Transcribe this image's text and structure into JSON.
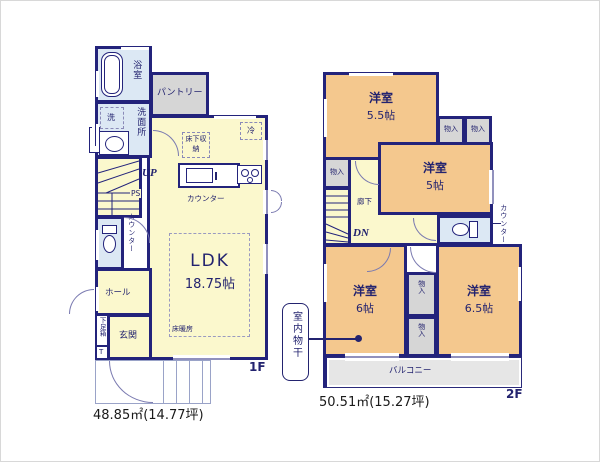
{
  "meta": {
    "floor1_label": "1F",
    "floor2_label": "2F",
    "floor1_area": "48.85㎡(14.77坪)",
    "floor2_area": "50.51㎡(15.27坪)"
  },
  "f1": {
    "bath": "浴室",
    "laundry": "洗",
    "washroom": "洗面所",
    "ps_wall": "PS",
    "pantry": "パントリー",
    "fridge": "冷",
    "underfloor_storage": "床下収納",
    "up": "UP",
    "ps_stairs": "PS",
    "kitchen_counter": "カウンター",
    "side_counter": "カウンター",
    "ldk": "LDK",
    "ldk_size": "18.75帖",
    "floor_heating": "床暖房",
    "hall": "ホール",
    "entrance": "玄関",
    "shoe_box": "下足箱",
    "shoe_box_t": "T"
  },
  "f2": {
    "room_nw": "洋室",
    "room_nw_size": "5.5帖",
    "room_ne": "洋室",
    "room_ne_size": "5帖",
    "room_sw": "洋室",
    "room_sw_size": "6帖",
    "room_se": "洋室",
    "room_se_size": "6.5帖",
    "closet_1": "物入",
    "closet_2": "物入",
    "closet_3": "物入",
    "closet_4": "物入",
    "closet_5": "物入",
    "hallway": "廊下",
    "dn": "DN",
    "counter": "カウンター",
    "balcony": "バルコニー",
    "indoor_laundry": "室内物干"
  },
  "colors": {
    "wall": "#23237b",
    "room_yellow": "#fbf8cd",
    "room_orange": "#f4c88e",
    "room_blue": "#dce8f4",
    "storage_gray": "#d6d6d6",
    "balcony_gray": "#e6e6e6",
    "label_navy": "#23236f"
  }
}
